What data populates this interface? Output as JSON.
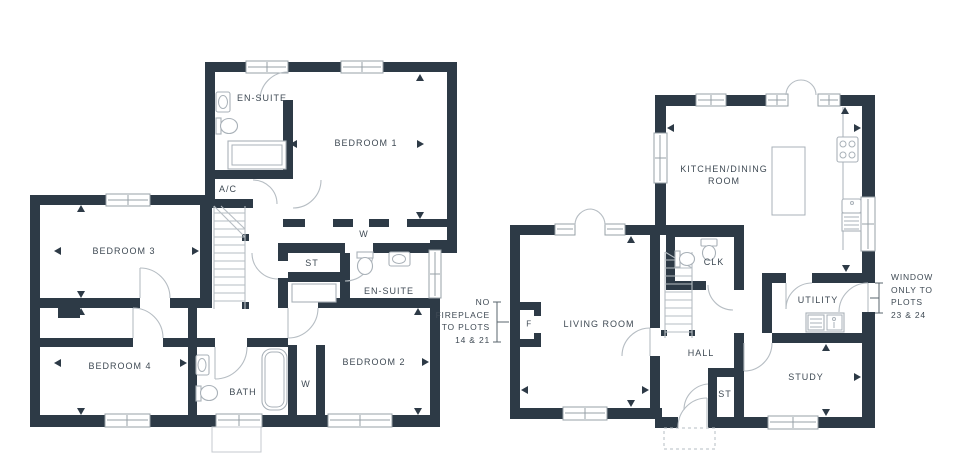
{
  "colors": {
    "wall": "#2d3a46",
    "line": "#b6bdc3",
    "text": "#3f4a54"
  },
  "first_floor": {
    "labels": {
      "ensuite_top": "EN-SUITE",
      "bedroom1": "BEDROOM 1",
      "ac": "A/C",
      "bedroom3": "BEDROOM 3",
      "wardrobe_top": "W",
      "storage": "ST",
      "ensuite_mid": "EN-SUITE",
      "bedroom4": "BEDROOM 4",
      "wardrobe_side": "W",
      "bath": "BATH",
      "bedroom2": "BEDROOM 2"
    }
  },
  "ground_floor": {
    "labels": {
      "kitchen_dining": "KITCHEN/DINING ROOM",
      "cloakroom": "CLK",
      "living_room": "LIVING ROOM",
      "fireplace": "F",
      "utility": "UTILITY",
      "hall": "HALL",
      "storage": "ST",
      "study": "STUDY"
    }
  },
  "annotations": {
    "fireplace_note": {
      "lines": [
        "NO",
        "FIREPLACE",
        "TO PLOTS",
        "14 & 21"
      ]
    },
    "window_note": {
      "lines": [
        "WINDOW",
        "ONLY TO",
        "PLOTS",
        "23 & 24"
      ]
    }
  }
}
